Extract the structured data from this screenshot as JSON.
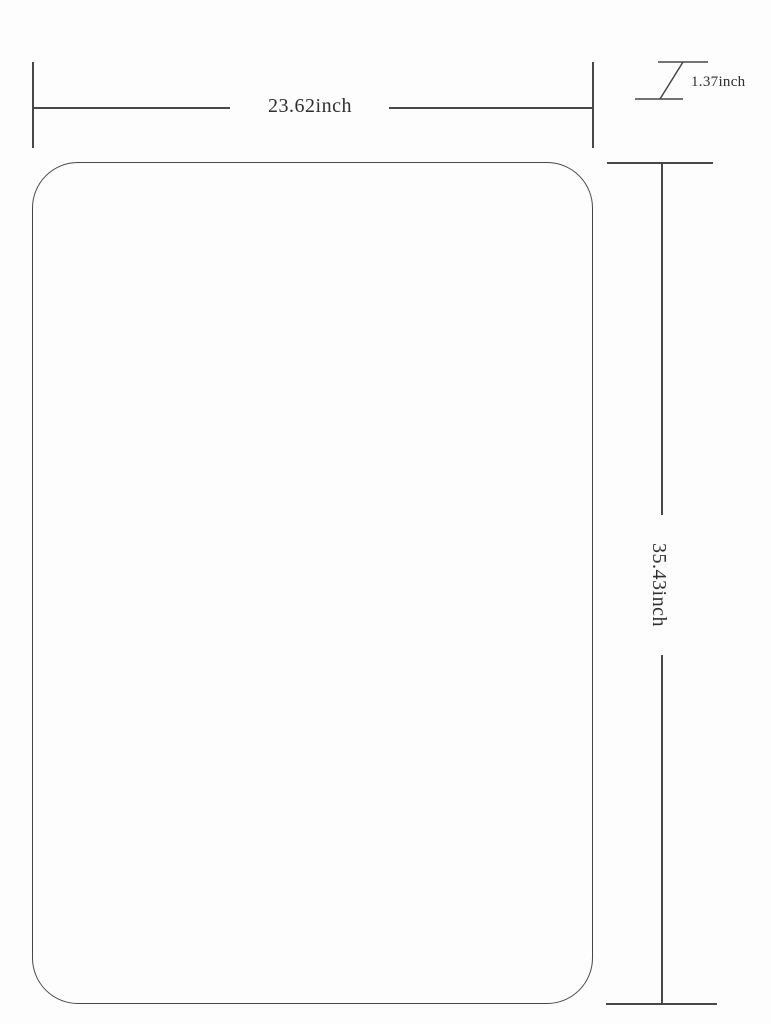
{
  "page": {
    "background": "#fdfdfd",
    "line_color": "#474747",
    "text_color": "#2e2e2e"
  },
  "diagram": {
    "title": "product-dimension-drawing",
    "width_label": "23.62inch",
    "height_label": "35.43inch",
    "thickness_label": "1.37inch"
  }
}
